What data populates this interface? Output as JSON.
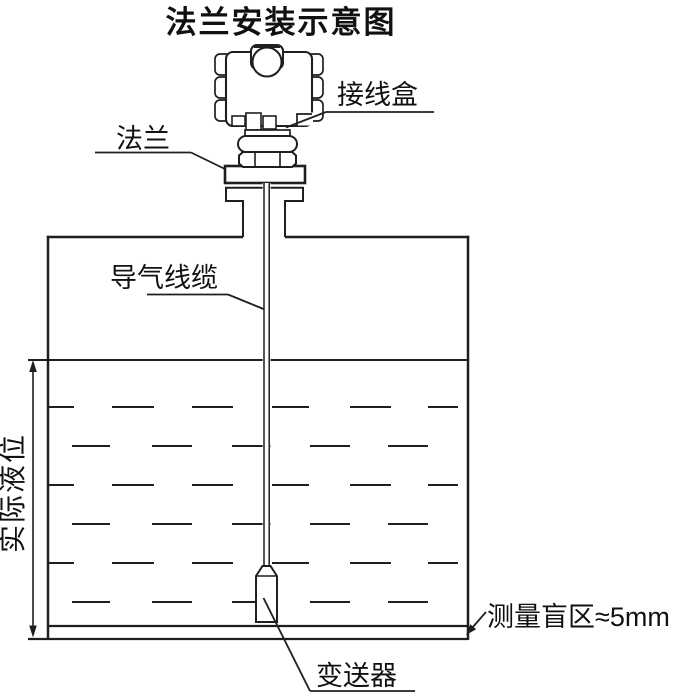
{
  "title": "法兰安装示意图",
  "labels": {
    "junction_box": "接线盒",
    "flange": "法兰",
    "air_cable": "导气线缆",
    "actual_level": "实际液位",
    "transmitter": "变送器",
    "blind_zone": "测量盲区≈5mm"
  },
  "colors": {
    "line": "#1f1f1f",
    "text": "#111111",
    "background": "#ffffff"
  }
}
